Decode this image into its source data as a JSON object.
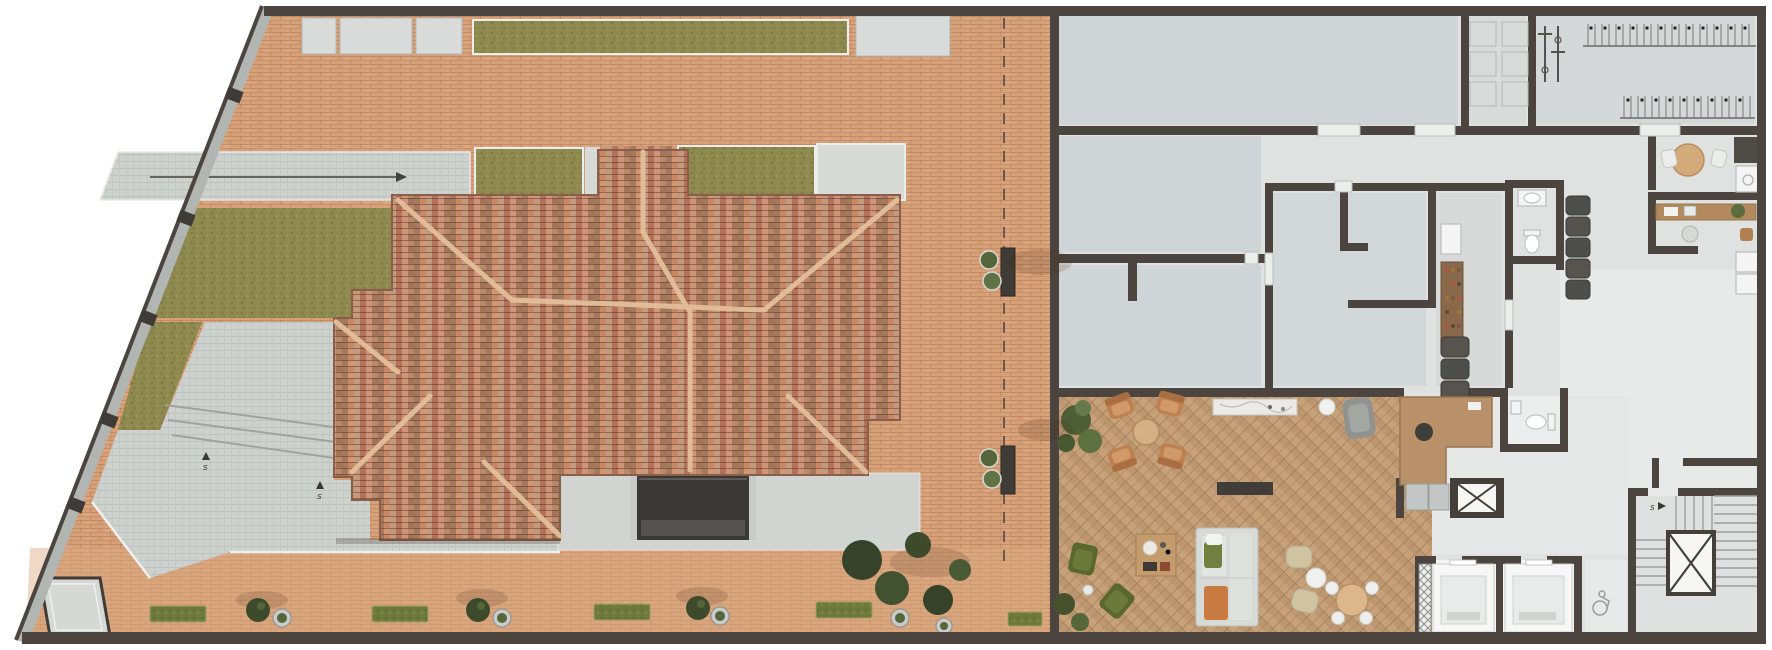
{
  "palette": {
    "page_bg": "#ffffff",
    "paving_brick": "#d6a078",
    "paving_light": "#dcab80",
    "plaza_stone": "#ced2cf",
    "lawn_green": "#8e894e",
    "hedge_green": "#6e793c",
    "roof_tile": "#bf8165",
    "roof_ridge": "#e3bf9a",
    "wall_dark": "#4c443e",
    "boundary_gray": "#b2b6b3",
    "floor_light": "#dfe2e1",
    "floor_room": "#cfd5d6",
    "floor_corridor": "#e8eae9",
    "lounge_wood": "#c7a179",
    "wood_furniture": "#b8916a",
    "marble": "#eceae6",
    "sofa_gray": "#d7dad6",
    "green_upholstery": "#5a682f",
    "tan_upholstery": "#bf8050",
    "dark_fixture": "#403c37",
    "white_fixture": "#f3f4f3",
    "tree_green": "#3d4a2c",
    "void_dark": "#3a3835",
    "dashed_line": "#6b5a48"
  },
  "labels": {
    "step_label": "s"
  },
  "inventory": {
    "outdoor": [
      "hipped-tile-roof",
      "green-roof-strips",
      "roof-access-hatch",
      "lawn",
      "stone-plaza",
      "plaza-steps",
      "entry-direction-arrow",
      "street-trees",
      "hedges",
      "planter-benches",
      "property-dashed-line",
      "skylight-box",
      "courtyard-void",
      "brick-paving"
    ],
    "interior": [
      "storage-boxes",
      "bike-racks",
      "wall-bike-hooks",
      "break-room-table",
      "kitchen-counter-sink",
      "pantry-shelf",
      "water-heaters",
      "toilets",
      "office-desk",
      "closets",
      "reception-desk",
      "lounge-armchairs",
      "coffee-tables",
      "bar-counter",
      "sofa",
      "poufs",
      "dining-set",
      "console-benches",
      "indoor-plants",
      "service-shaft",
      "elevators",
      "stairwell",
      "accessible-wc"
    ]
  }
}
